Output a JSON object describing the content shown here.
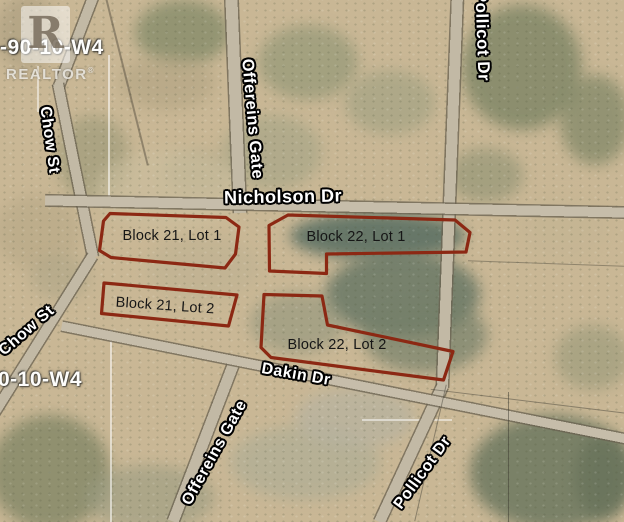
{
  "colors": {
    "lot_outline": "#8c2813"
  },
  "watermark": {
    "logo_letter": "R",
    "brand": "REALTOR",
    "registered_mark": "®"
  },
  "township_grid": {
    "top_left": "-90-10-W4",
    "bottom_left": "0-10-W4"
  },
  "streets": {
    "chow": "Chow St",
    "offereins": "Offereins Gate",
    "pollicot": "Pollicot Dr",
    "nicholson": "Nicholson Dr",
    "dakin": "Dakin Dr"
  },
  "lots": [
    {
      "label": "Block 21, Lot 1"
    },
    {
      "label": "Block 21, Lot 2"
    },
    {
      "label": "Block 22, Lot 1"
    },
    {
      "label": "Block 22, Lot 2"
    }
  ]
}
